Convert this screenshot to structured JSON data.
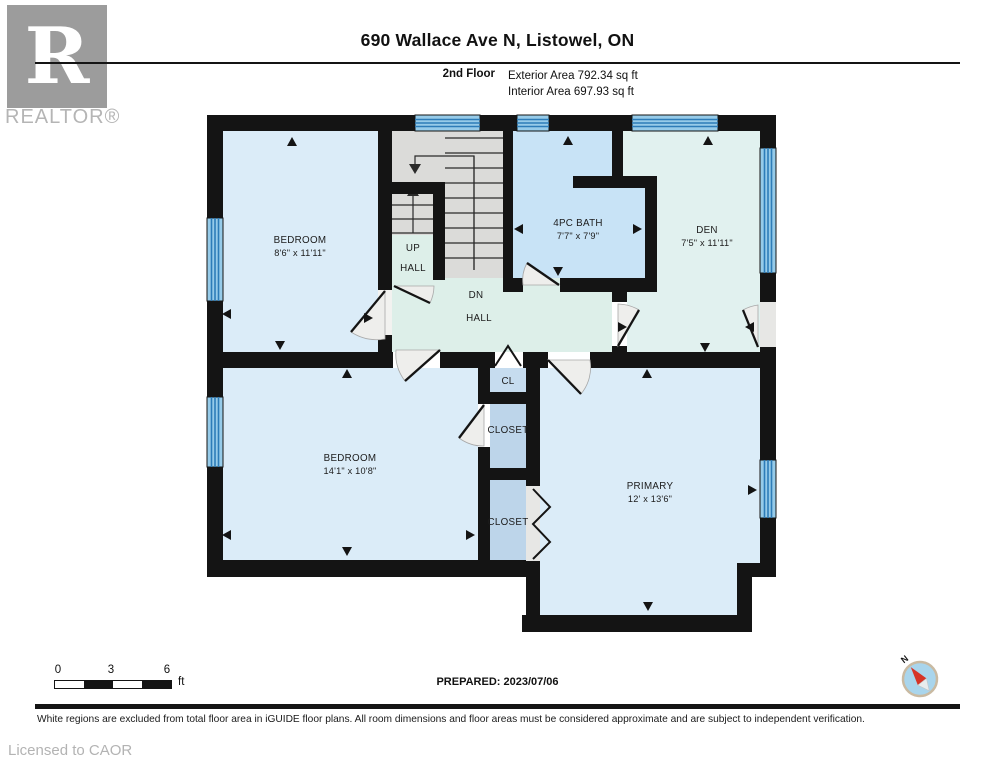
{
  "header": {
    "title": "690 Wallace Ave N, Listowel, ON",
    "floor_label": "2nd Floor",
    "exterior_area": "Exterior Area 792.34 sq ft",
    "interior_area": "Interior Area 697.93 sq ft"
  },
  "branding": {
    "logo_letter": "R",
    "logo_text": "REALTOR®"
  },
  "rooms": {
    "bedroom1": {
      "name": "BEDROOM",
      "dims": "8'6\" x 11'11\""
    },
    "bedroom2": {
      "name": "BEDROOM",
      "dims": "14'1\" x 10'8\""
    },
    "bath": {
      "name": "4PC BATH",
      "dims": "7'7\" x 7'9\""
    },
    "den": {
      "name": "DEN",
      "dims": "7'5\" x 11'11\""
    },
    "primary": {
      "name": "PRIMARY",
      "dims": "12' x 13'6\""
    },
    "up_hall": {
      "line1": "UP",
      "line2": "HALL"
    },
    "dn_hall": {
      "line1": "DN",
      "line2": "HALL"
    },
    "cl": {
      "name": "CL"
    },
    "closet_upper": {
      "name": "CLOSET"
    },
    "closet_lower": {
      "name": "CLOSET"
    }
  },
  "scale_bar": {
    "tick0": "0",
    "tick1": "3",
    "tick2": "6",
    "unit": "ft"
  },
  "prepared_label": "PREPARED: 2023/07/06",
  "compass": {
    "north_label": "N"
  },
  "footer": {
    "disclaimer": "White regions are excluded from total floor area in iGUIDE floor plans. All room dimensions and floor areas must be considered approximate and are subject to independent verification.",
    "license": "Licensed to CAOR"
  },
  "colors": {
    "wall": "#141414",
    "room_blue": "#dbecf8",
    "bath_blue": "#c8e3f6",
    "den_green": "#e1f1ef",
    "hall_green": "#ddefe9",
    "closet_blue": "#bdd5ea",
    "cl_blue": "#c6dcef",
    "stair_gray": "#dbdbd9",
    "window_fill": "#96cbe9",
    "window_stripe": "#2d7cb8",
    "compass_red": "#d63427",
    "logo_gray": "#9c9c9c"
  }
}
